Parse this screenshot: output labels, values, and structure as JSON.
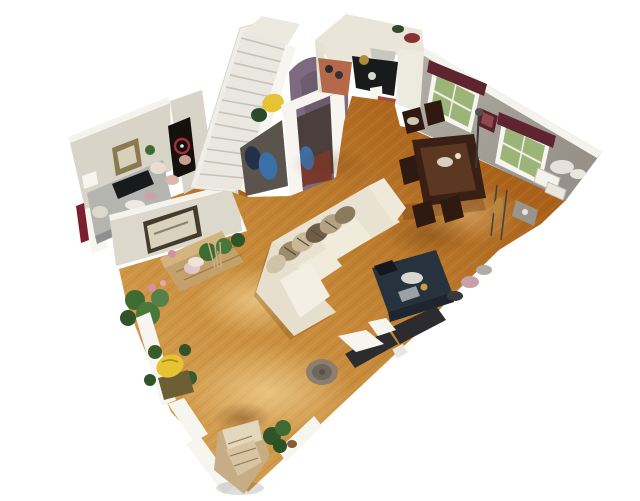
{
  "viewport": {
    "width": 640,
    "height": 501,
    "background": "#ffffff"
  },
  "scene": {
    "description": "3D dollhouse overhead scan of an apartment floor, tilted on a white background: hardwood living and dining rooms, kitchen, office nook, and a white staircase beside a curved mauve wall",
    "rooms": {
      "office": {
        "label": "Office nook with gray desk, black keyboard, framed pictures, thermostat and dark poster"
      },
      "staircase": {
        "label": "White staircase with railing ascending to the upper floor"
      },
      "hallway": {
        "label": "Entry hall with curved mauve wall, doorway arch and coats hanging beneath the stairs"
      },
      "kitchen": {
        "label": "Kitchen with cream cabinets, black range, range hood and terracotta floor"
      },
      "dining": {
        "label": "Dining area along a gray wall with two windows dressed in dark maroon valances"
      },
      "living": {
        "label": "Living room with cream sectional sofa, patterned pillows and navy coffee table on honey hardwood"
      }
    },
    "objects": {
      "floor": {
        "label": "Honey-colored hardwood plank flooring"
      },
      "sofa": {
        "label": "Cream L-shaped sectional sofa with animal-print throw pillows"
      },
      "coffee_table": {
        "label": "Navy blue coffee table with books and decor on top"
      },
      "dining_set": {
        "label": "Dark wood dining table surrounded by chairs"
      },
      "windows": {
        "label": "Two windows with maroon valances overlooking greenery, small red frame between them"
      },
      "stands": {
        "label": "Floor lamp, music stands and brass instrument near the windows"
      },
      "console": {
        "label": "Dark media console and clutter along the open floor edge"
      },
      "bench": {
        "label": "Tan bench with pink flowers and potted plants along the office wall"
      },
      "yellow_chair": {
        "label": "Yellow floral chair ringed by houseplants"
      },
      "pouf": {
        "label": "Round woven pouf on the living room floor"
      },
      "armchair": {
        "label": "Tan patterned armchair with green shrub at the bottom corner"
      },
      "red_sliver": {
        "label": "Dark red painted wall edge at the far left"
      }
    }
  },
  "palette": {
    "background": "#ffffff",
    "floor_light": "#d49e50",
    "floor_mid": "#c68938",
    "floor_dark": "#a96018",
    "plank_line": "#7a3c0e",
    "wall_cream": "#d8d4c8",
    "wall_gray": "#a8a49b",
    "wall_cap": "#f4f3ee",
    "stairs": "#efeee7",
    "stair_line": "#c6c2b4",
    "purple": "#7e6a7e",
    "purple_dark": "#5f4f60",
    "valance": "#5e2430",
    "window_green": "#9db478",
    "frame_red": "#5a2028",
    "desk_gray": "#b4b4b1",
    "keyboard_black": "#181a1c",
    "sofa": "#e9e2d0",
    "cushion": "#f1ebdc",
    "pillow_tan": "#b3a383",
    "pillow_brown": "#6e5d48",
    "navy": "#27323f",
    "dining_table": "#3a2014",
    "chair": "#2e1a10",
    "plant": "#3e6b31",
    "plant_dark": "#2f5427",
    "flower_pink": "#d690a4",
    "bench": "#c4a06a",
    "yellow": "#e6c332",
    "pouf": "#8b7f6f",
    "armchair": "#c6ad85",
    "console": "#2c2b2e",
    "red_sliver": "#7a1f2b",
    "terracotta": "#b4694a",
    "radiator": "#75726a"
  }
}
